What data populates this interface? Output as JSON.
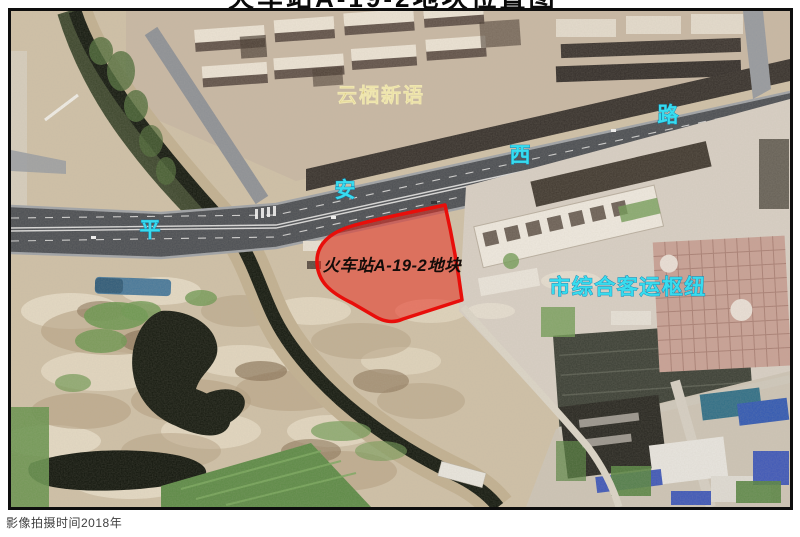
{
  "title": {
    "clipped_text": "火车站A-19-2地块位置图"
  },
  "map": {
    "labels": {
      "residential_area": "云栖新语",
      "road_chars": [
        "平",
        "安",
        "西",
        "路"
      ],
      "road_name": "平安西路",
      "parcel": "火车站A-19-2地块",
      "transit_hub": "市综合客运枢纽"
    },
    "colors": {
      "parcel_fill": "#ea2a1c",
      "parcel_border": "#e80e0a",
      "road_label_fill": "#38dcee",
      "residential_label_fill": "#d6c476",
      "hub_label_fill": "#38dcee",
      "parcel_label_color": "#140c09"
    }
  },
  "caption": {
    "text": "影像拍摄时间2018年"
  }
}
